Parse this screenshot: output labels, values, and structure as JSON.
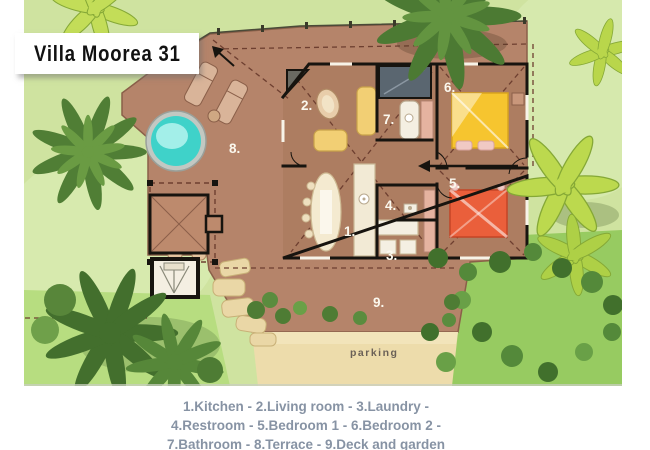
{
  "title": "Villa Moorea 31",
  "legend_lines": [
    "1.Kitchen - 2.Living room - 3.Laundry -",
    "4.Restroom - 5.Bedroom 1 - 6.Bedroom 2 -",
    "7.Bathroom - 8.Terrace - 9.Deck and garden"
  ],
  "rooms": [
    {
      "label": "1.",
      "name": "Kitchen"
    },
    {
      "label": "2.",
      "name": "Living room"
    },
    {
      "label": "3.",
      "name": "Laundry"
    },
    {
      "label": "4.",
      "name": "Restroom"
    },
    {
      "label": "5.",
      "name": "Bedroom 1"
    },
    {
      "label": "6.",
      "name": "Bedroom 2"
    },
    {
      "label": "7.",
      "name": "Bathroom"
    },
    {
      "label": "8.",
      "name": "Terrace"
    },
    {
      "label": "9.",
      "name": "Deck and garden"
    }
  ],
  "parking_label": "parking",
  "colors": {
    "grass": "#cfe3a0",
    "garden_dark": "#9fd169",
    "deck": "#b5846a",
    "house_floor": "#ad7d61",
    "walls": "#17140f",
    "pool_water": "#3fd2c9",
    "bed1": "#ea5f3b",
    "bed2": "#f6c52f",
    "parking": "#eddcab",
    "legend_text": "#8793a4",
    "title_text": "#111111"
  }
}
